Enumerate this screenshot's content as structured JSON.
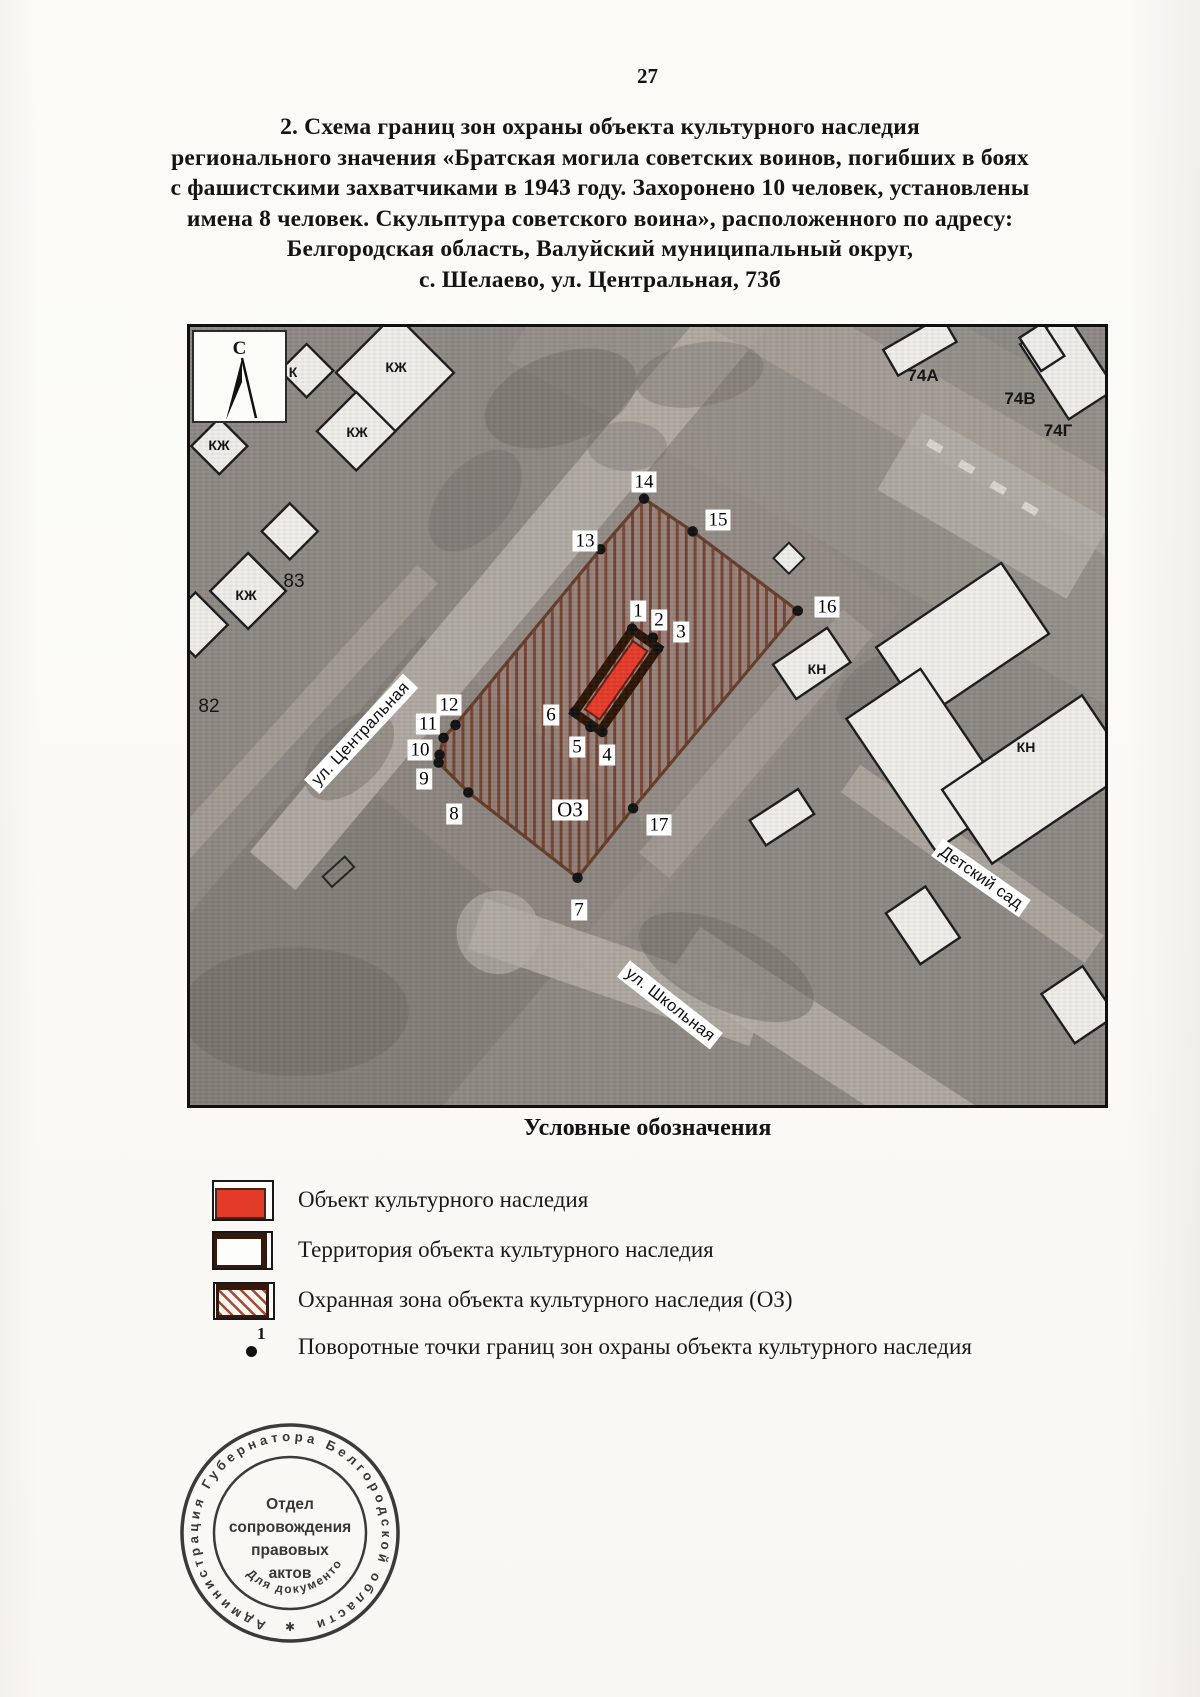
{
  "page": {
    "number": "27"
  },
  "title": {
    "lines": [
      "2. Схема границ зон охраны объекта культурного наследия",
      "регионального значения «Братская могила советских воинов, погибших в боях",
      "с фашистскими захватчиками в 1943 году. Захоронено 10 человек, установлены",
      "имена 8 человек. Скульптура советского воина», расположенного по адресу:",
      "Белгородская область, Валуйский муниципальный округ,",
      "с. Шелаево, ул. Центральная, 73б"
    ]
  },
  "map": {
    "north_label": "С",
    "zone_label": "ОЗ",
    "streets": {
      "central": "ул. Центральная",
      "school": "ул. Школьная",
      "kindergarten": "Детский сад"
    },
    "buildings": {
      "kzh": "КЖ",
      "k": "К",
      "kn": "КН",
      "n83": "83",
      "n82": "82",
      "n74a": "74А",
      "n74b": "74В",
      "n74g": "74Г"
    },
    "points": [
      "1",
      "2",
      "3",
      "4",
      "5",
      "6",
      "7",
      "8",
      "9",
      "10",
      "11",
      "12",
      "13",
      "14",
      "15",
      "16",
      "17"
    ]
  },
  "legend": {
    "title": "Условные обозначения",
    "items": [
      {
        "label": "Объект культурного наследия"
      },
      {
        "label": "Территория объекта культурного наследия"
      },
      {
        "label": "Охранная зона объекта культурного наследия (ОЗ)"
      },
      {
        "label": "Поворотные точки границ зон охраны объекта культурного наследия",
        "marker_number": "1"
      }
    ]
  },
  "stamp": {
    "ring_text": "Администрация Губернатора Белгородской области",
    "center_lines": [
      "Отдел",
      "сопровождения",
      "правовых",
      "актов"
    ],
    "bottom_arc": "Для документов",
    "star": "✱"
  },
  "colors": {
    "monument_red": "#e53a28",
    "zone_border_brown": "#5a2a14",
    "territory_dark_brown": "#2a1304"
  }
}
